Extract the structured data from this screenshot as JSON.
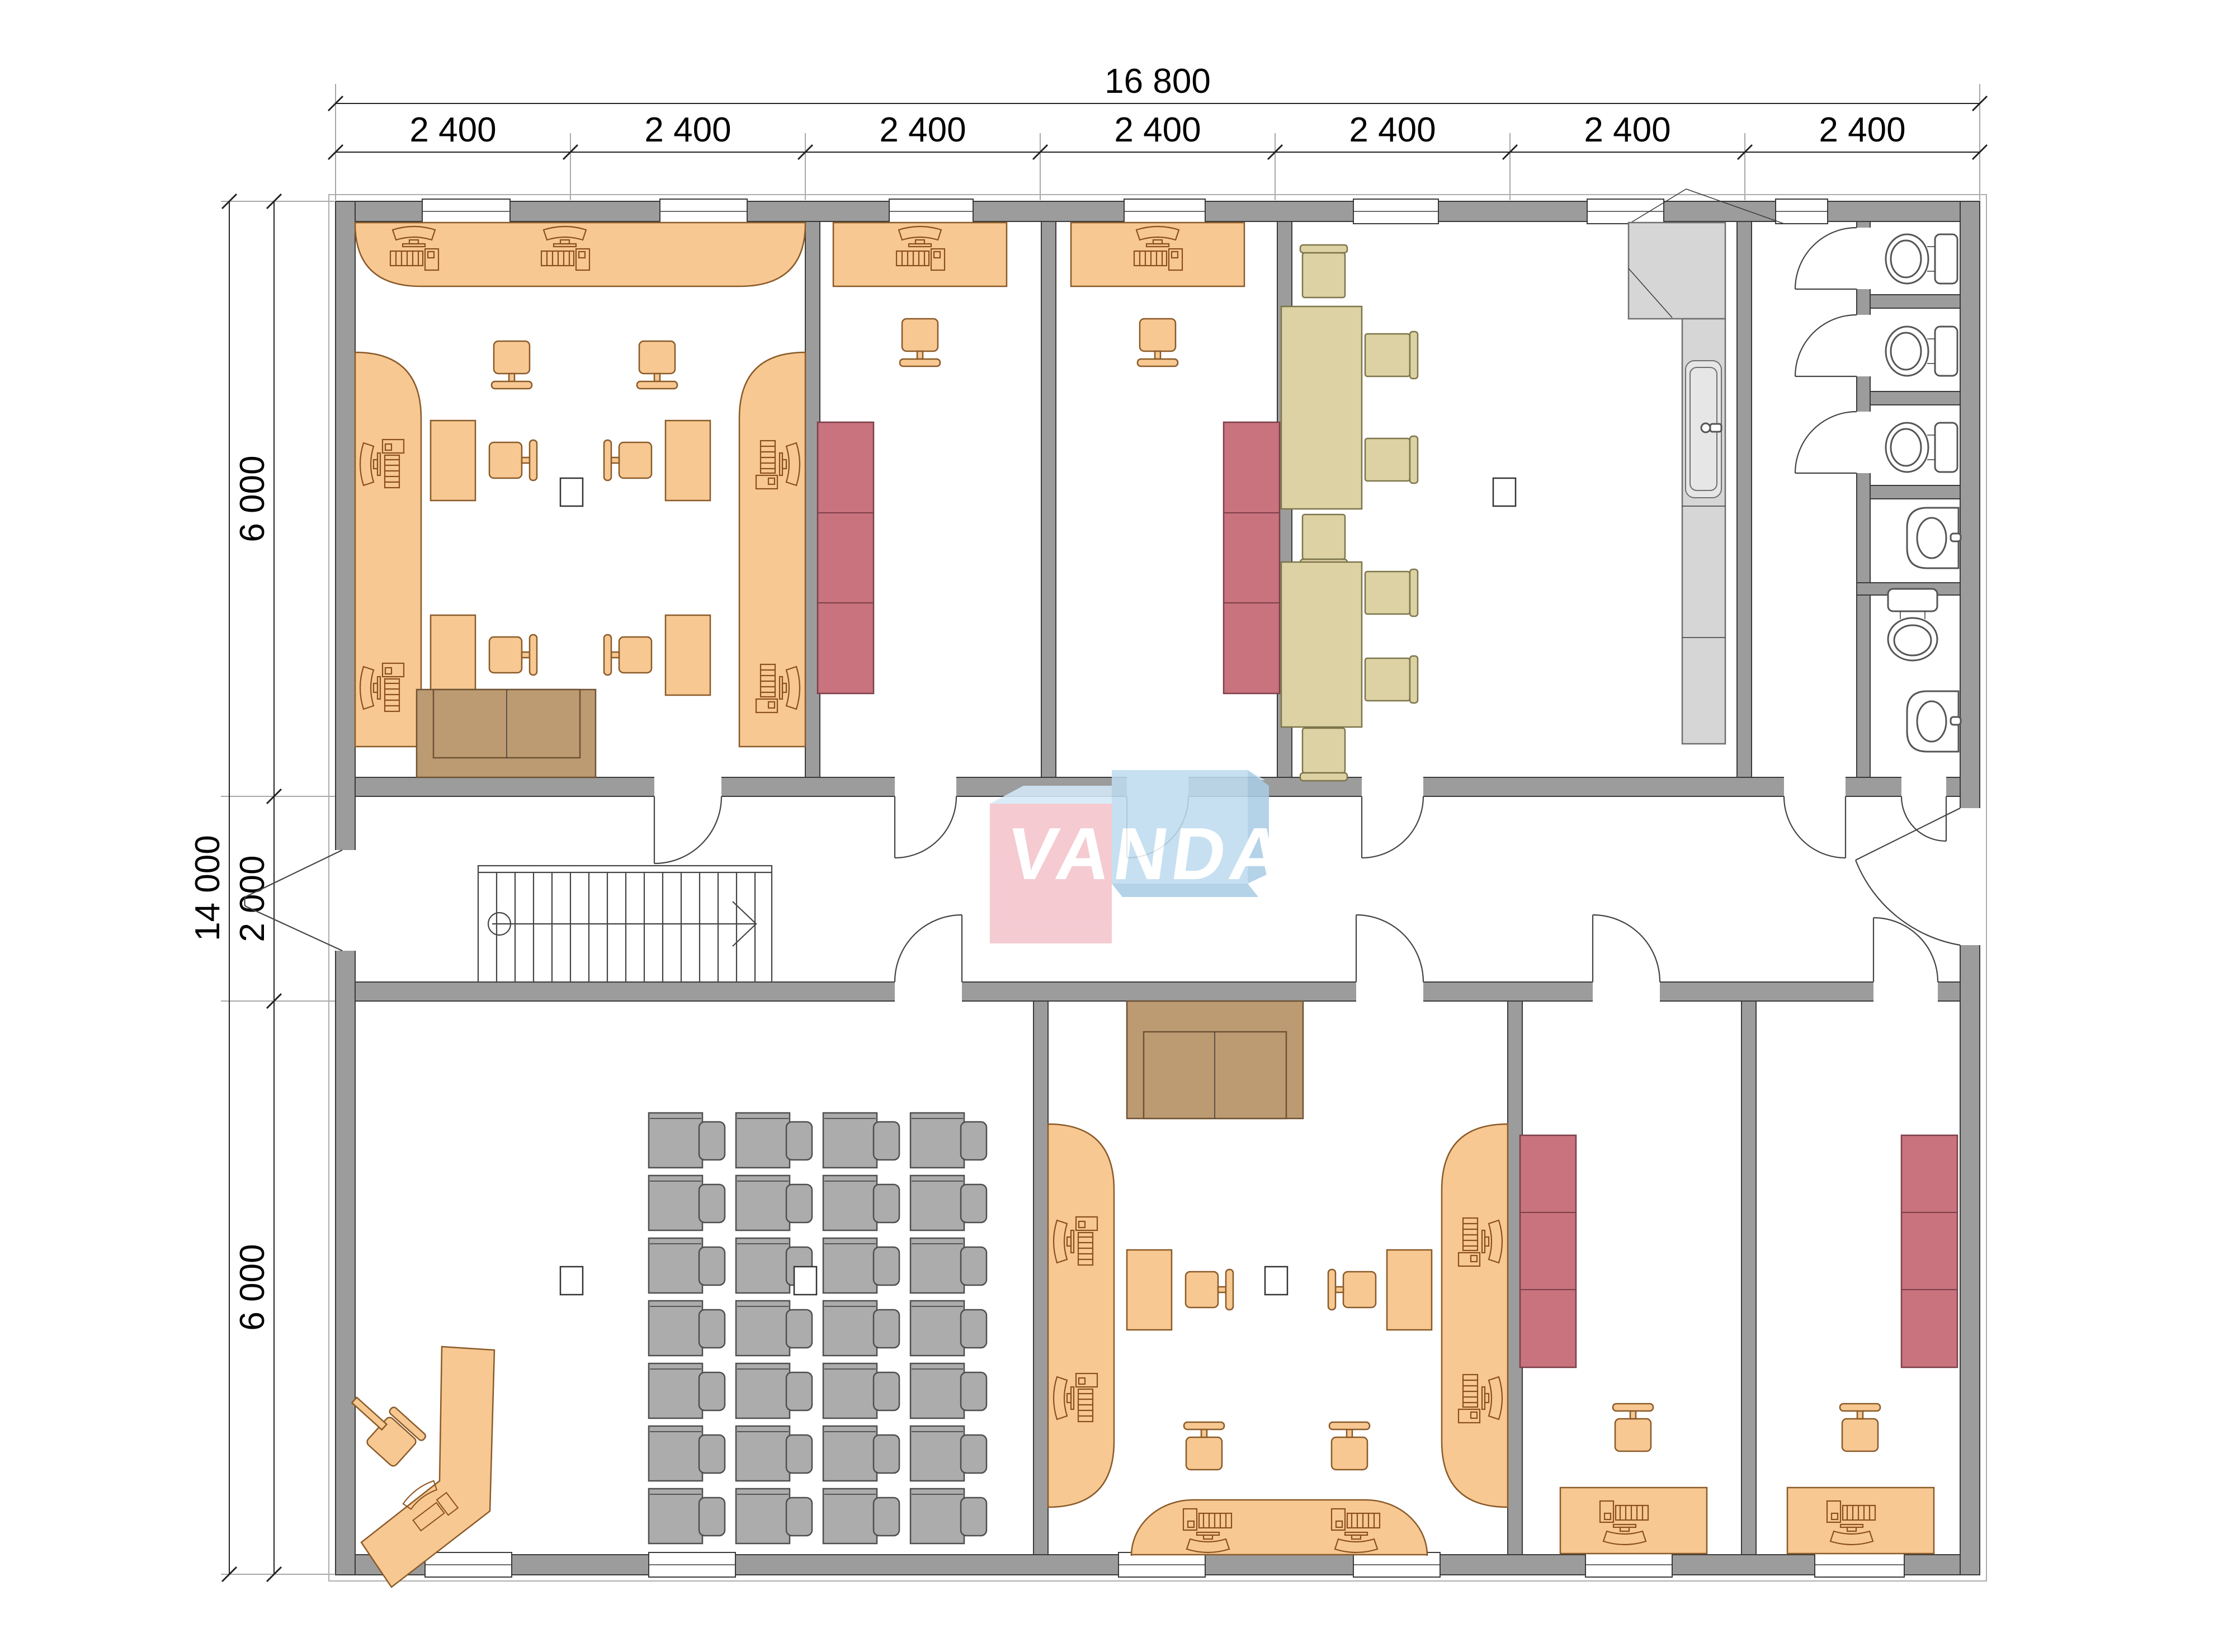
{
  "logo": {
    "text": "VANDA"
  },
  "dimensions": {
    "top_total": "16 800",
    "top_segments": [
      "2 400",
      "2 400",
      "2 400",
      "2 400",
      "2 400",
      "2 400",
      "2 400"
    ],
    "left_total": "14 000",
    "left_segments": [
      "6 000",
      "2 000",
      "6 000"
    ]
  },
  "colors": {
    "wall": "#9c9c9c",
    "desk": "#f8c893",
    "cabinet": "#c8737e",
    "table": "#dcd2a4",
    "kitchen": "#d6d6d6",
    "student-desk": "#acacac",
    "sofa": "#bd9b72",
    "logo-pink": "#f4c3cb",
    "logo-blue": "#bedcf0",
    "logo-bevel": "#d5eaf8",
    "logo-text": "#ffffff"
  }
}
